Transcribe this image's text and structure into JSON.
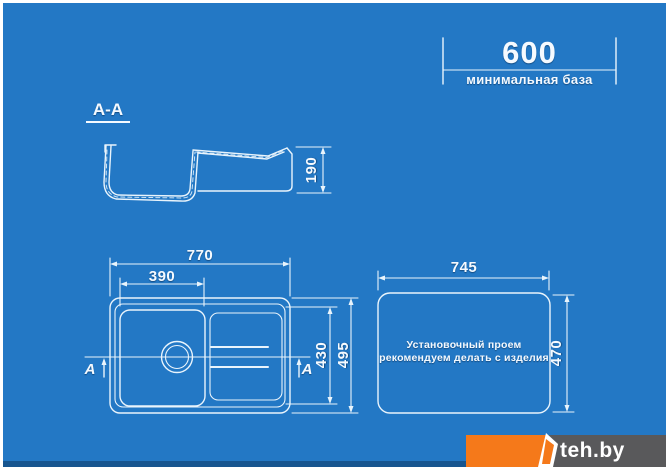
{
  "colors": {
    "background": "#2378C5",
    "linework": "#E9F4FC",
    "text": "#F5FAFF",
    "logo_orange": "#F5791A",
    "logo_gray": "#59595B"
  },
  "base_dimension": {
    "value": "600",
    "caption": "минимальная база"
  },
  "section": {
    "label": "А-А",
    "depth": "190"
  },
  "plan": {
    "overall_width": "770",
    "bowl_width": "390",
    "bowl_depth": "430",
    "overall_depth": "495",
    "cut_marker_left": "А",
    "cut_marker_right": "А"
  },
  "cutout": {
    "width": "745",
    "depth": "470",
    "note_line1": "Установочный проем",
    "note_line2": "рекомендуем делать с изделия"
  },
  "logo": {
    "brand": "teh.by"
  }
}
